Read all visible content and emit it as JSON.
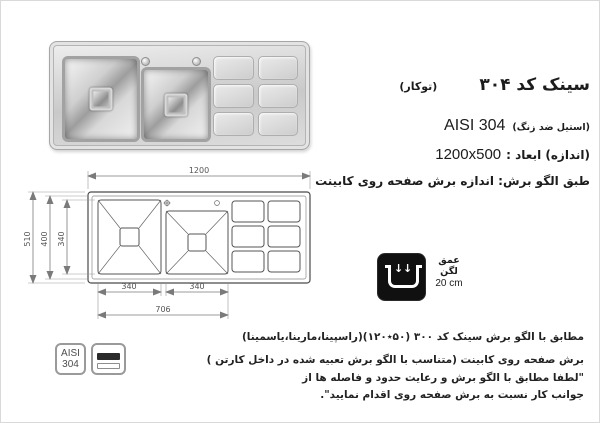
{
  "title": {
    "main": "سینک کد ۳۰۴",
    "sub": "(توکار)"
  },
  "specs": {
    "steel_fa": "(استیل ضد زنگ)",
    "steel_en": "AISI 304",
    "size_label": "(اندازه) ابعاد :",
    "size_value": "1200x500",
    "cut_note": "طبق الگو برش: اندازه برش صفحه روی کابینت"
  },
  "drawing": {
    "width": "1200",
    "height_outer": "510",
    "height_inner": "400",
    "bowl_height": "340",
    "bowl1_width": "340",
    "bowl2_width": "340",
    "bowls_total": "706"
  },
  "depth": {
    "label": "عمق لگن",
    "value": "20 cm"
  },
  "badges": {
    "aisi_top": "AISI",
    "aisi_bottom": "304"
  },
  "notes": {
    "line1": "مطابق با الگو برش سینک کد ۳۰۰ (۵۰٭۱۲۰)(راسپینا،مارینا،یاسمینا)",
    "line2": "برش صفحه روی کابینت (متناسب با الگو برش تعبیه شده در داخل کارتن )",
    "line3": "\"لطفا مطابق با الگو برش و رعایت حدود و فاصله ها از",
    "line4": "جوانب کار نسبت به برش صفحه روی اقدام نمایید\"."
  }
}
